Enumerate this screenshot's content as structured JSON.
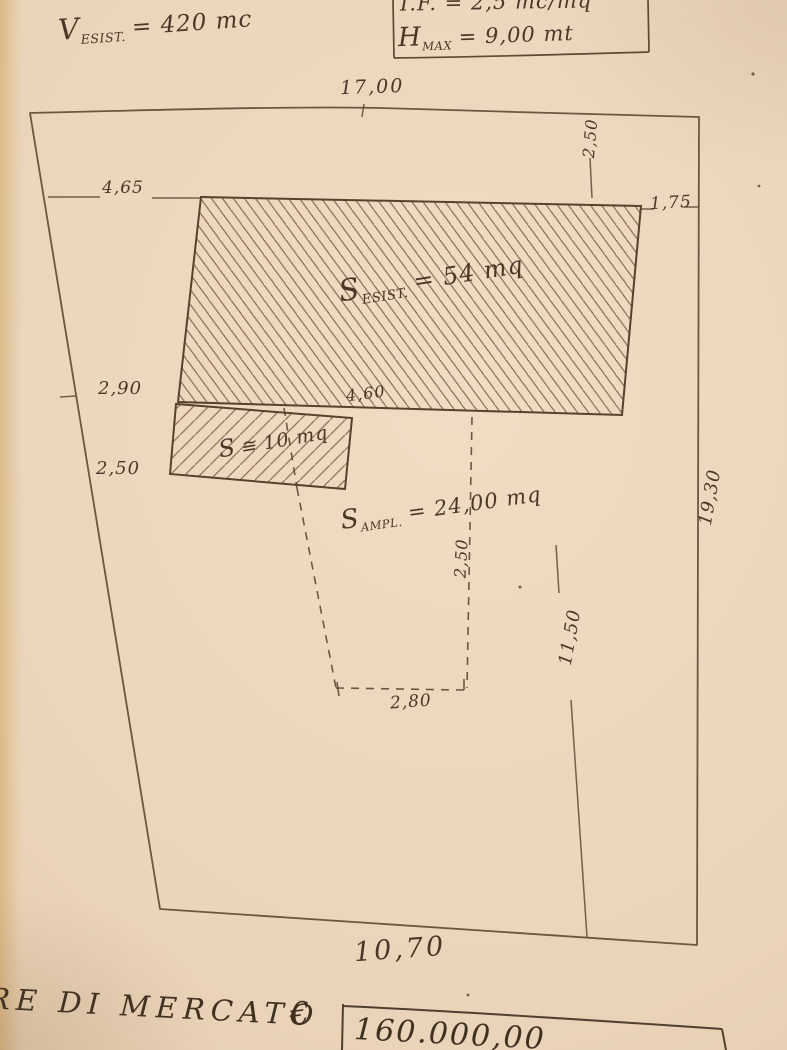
{
  "annotations": {
    "v_esist": {
      "base": "V",
      "sub": "ESIST.",
      "rest": "= 420 mc"
    },
    "if_line": "I.F. = 2,5 mc/mq",
    "h_max": {
      "base": "H",
      "sub": "MAX",
      "rest": "= 9,00 mt"
    },
    "s_esist": {
      "base": "S",
      "sub": "ESIST.",
      "rest": "= 54 mq"
    },
    "s_small": {
      "base": "S",
      "rest": "≅ 10 mq"
    },
    "s_ampl": {
      "base": "S",
      "sub": "AMPL.",
      "rest": "= 24,00 mq"
    }
  },
  "dimensions": {
    "top_width": "17,00",
    "top_right_offset": "2,50",
    "left_top": "4,65",
    "right_top": "1,75",
    "left_mid": "2,90",
    "building_bottom": "4,60",
    "left_lower": "2,50",
    "ampl_depth": "2,50",
    "ampl_width": "2,80",
    "right_inner": "11,50",
    "right_outer": "19,30",
    "bottom_width": "10,70"
  },
  "footer": {
    "label": "RE DI MERCATO",
    "currency": "€",
    "value": "160.000,00"
  },
  "colors": {
    "ink": "#4a3726",
    "paper": "#ead4b9"
  }
}
